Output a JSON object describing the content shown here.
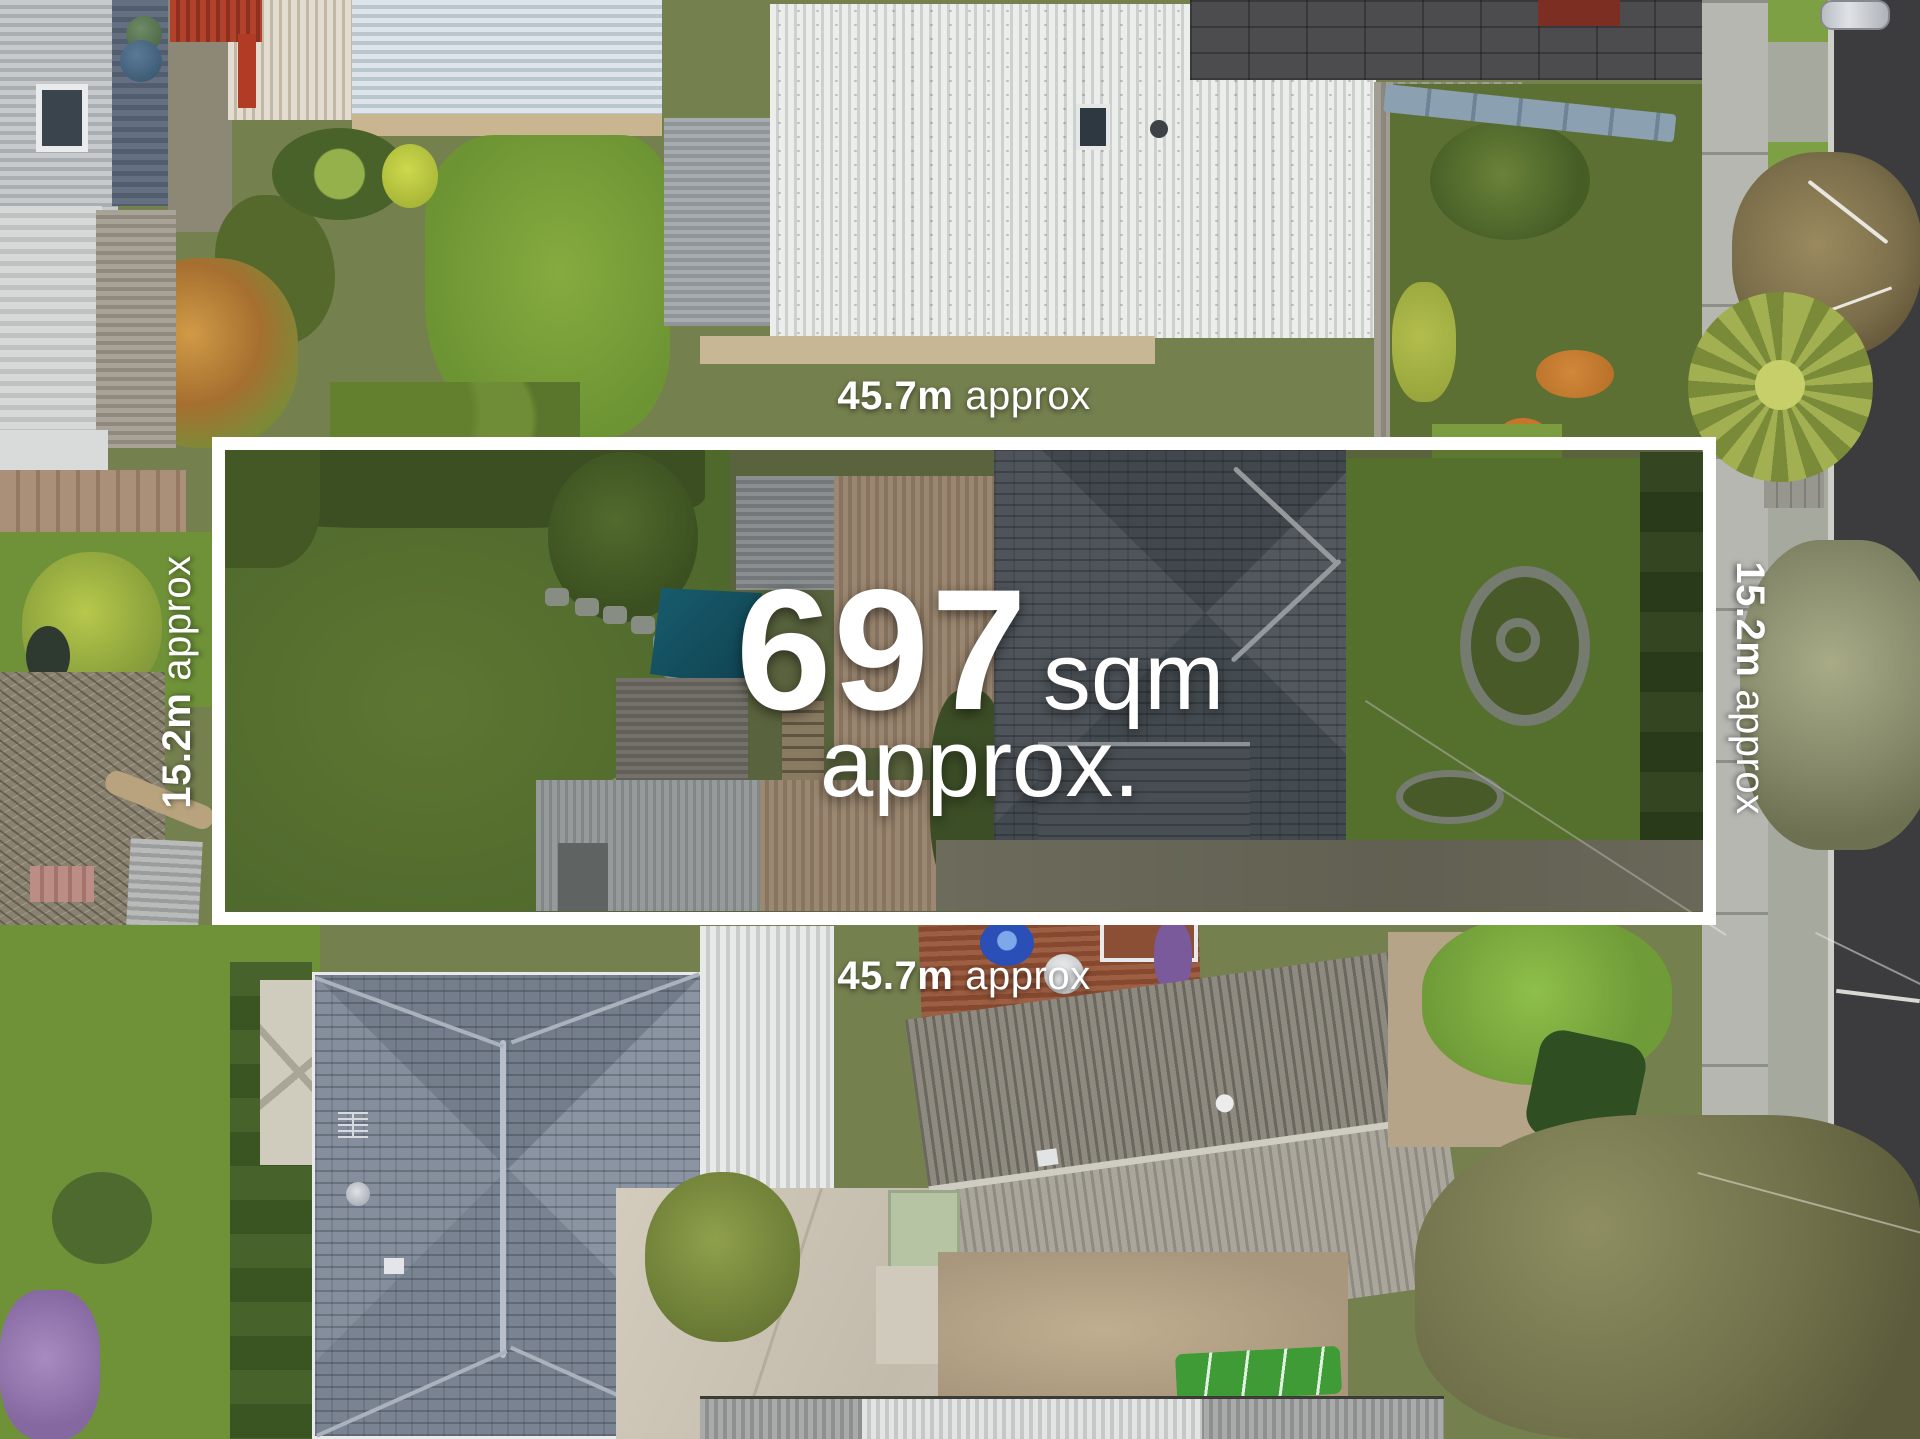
{
  "meta": {
    "description": "Aerial drone photograph of a residential land parcel with a white boundary outline, land area and boundary dimension overlays",
    "width_px": 1920,
    "height_px": 1439
  },
  "area_overlay": {
    "value": "697",
    "unit": "sqm",
    "qualifier": "approx."
  },
  "dimension_labels": {
    "top": {
      "value": "45.7m",
      "qualifier": "approx"
    },
    "bottom": {
      "value": "45.7m",
      "qualifier": "approx"
    },
    "left": {
      "value": "15.2m",
      "qualifier": "approx"
    },
    "right": {
      "value": "15.2m",
      "qualifier": "approx"
    }
  },
  "boundary_overlay": {
    "border_color": "#ffffff",
    "interior_tint": "rgba(8,10,8,0.25)",
    "label_text_color": "#ffffff"
  },
  "scene_palette": {
    "pool": "#1d7890",
    "lawn": "#6f9238",
    "road_asphalt": "#3c3c3e",
    "footpath": "#b6b7b1",
    "main_house_roof": "#60666e",
    "neighbor_roof_white": "#e6e8e7",
    "neighbor_roof_blue_gray": "#828b99",
    "deck_timber": "#8a4f33",
    "driveway_concrete": "#cfc8b8"
  }
}
